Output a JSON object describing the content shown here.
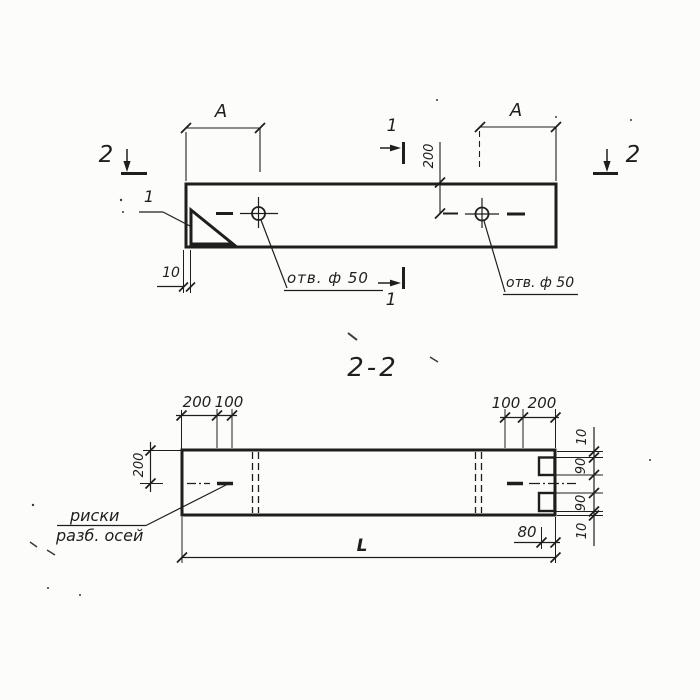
{
  "drawing": {
    "section_title": "2-2",
    "colors": {
      "ink": "#1e1e1e",
      "paper": "#fcfcfa"
    },
    "plan": {
      "dim_a_left": "A",
      "dim_a_right": "A",
      "dim_200": "200",
      "dim_10": "10",
      "detail_label": "1",
      "section_mark_1": "1",
      "section_mark_2": "2",
      "hole_label": "отв. ф 50"
    },
    "section": {
      "dim_200": "200",
      "top_left_dims": [
        "200",
        "100"
      ],
      "top_right_dims": [
        "100",
        "200"
      ],
      "right_dims": [
        "10",
        "90",
        "90",
        "10"
      ],
      "dim_80": "80",
      "length_label": "L",
      "axis_note_line1": "риски",
      "axis_note_line2": "разб. осей"
    }
  }
}
